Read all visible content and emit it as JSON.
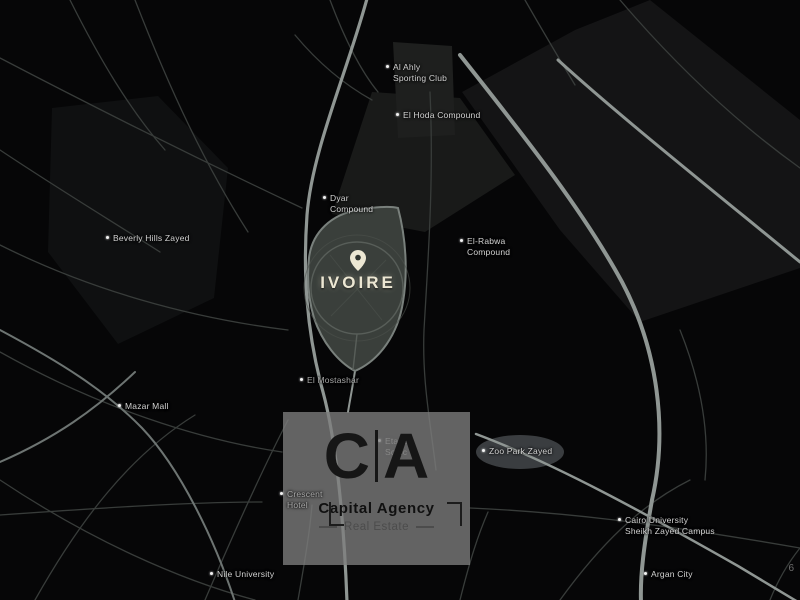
{
  "map": {
    "project": {
      "name": "IVOIRE"
    },
    "labels": {
      "al_ahly": {
        "line1": "Al Ahly",
        "line2": "Sporting Club"
      },
      "el_hoda": {
        "line1": "El Hoda Compound",
        "line2": ""
      },
      "dyar": {
        "line1": "Dyar",
        "line2": "Compound"
      },
      "el_rabwa": {
        "line1": "El-Rabwa",
        "line2": "Compound"
      },
      "beverly_hills": {
        "line1": "Beverly Hills Zayed",
        "line2": ""
      },
      "el_mostashar": {
        "line1": "El Mostashar",
        "line2": ""
      },
      "mazar_mall": {
        "line1": "Mazar Mall",
        "line2": ""
      },
      "zoo_park": {
        "line1": "Zoo Park Zayed",
        "line2": ""
      },
      "crescent": {
        "line1": "Crescent",
        "line2": "Hotel"
      },
      "etapa": {
        "line1": "Etapa",
        "line2": "Sodic"
      },
      "cairo_university": {
        "line1": "Cairo University",
        "line2": "Sheikh Zayed Campus"
      },
      "nile_university": {
        "line1": "Nile University",
        "line2": ""
      },
      "argan_city": {
        "line1": "Argan City",
        "line2": ""
      }
    },
    "corner_mark": "6"
  },
  "watermark": {
    "logo_left": "C",
    "logo_right": "A",
    "title": "Capital Agency",
    "subtitle": "Real Estate"
  },
  "colors": {
    "background": "#060607",
    "road_major": "#8f9693",
    "road_minor": "#383c3a",
    "parcel_fill": "#3a3f3b",
    "parcel_stroke": "#79807c",
    "project_text": "#ece7d3",
    "watermark_box": "#7e7e7e",
    "watermark_logo": "#161616",
    "label_text": "#d3d3d3"
  }
}
